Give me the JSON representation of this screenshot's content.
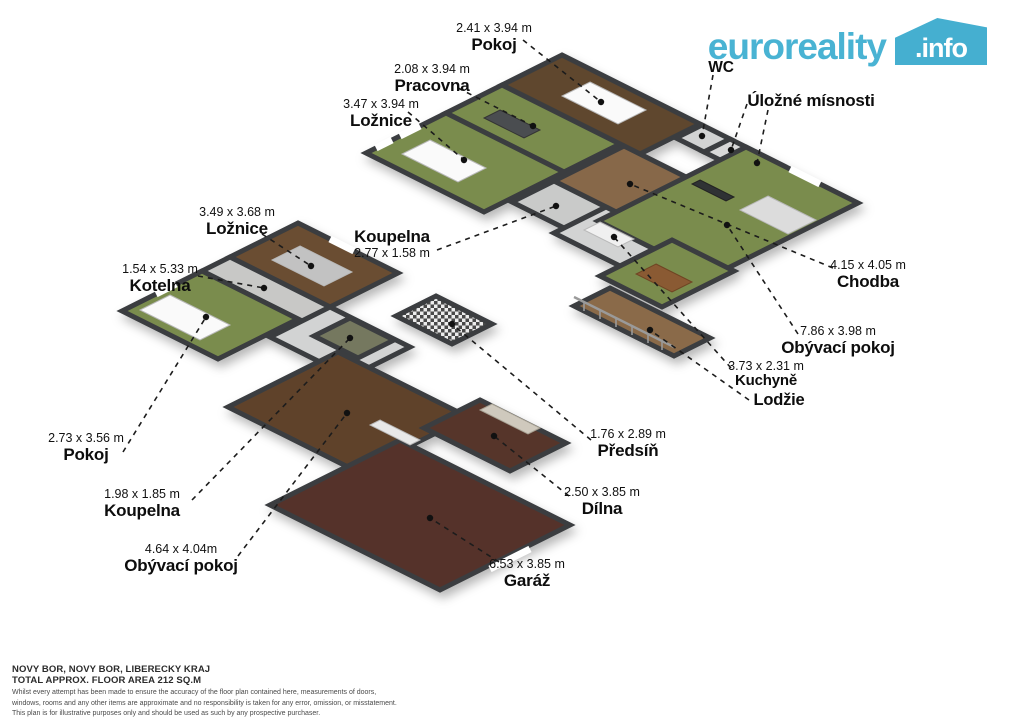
{
  "logo": {
    "brand": "euroreality",
    "tld": ".info",
    "accent_color": "#49b3d3"
  },
  "floors": {
    "upper": [
      "Pokoj",
      "Pracovna",
      "Ložnice",
      "WC",
      "Úložné mísnosti",
      "Koupelna",
      "Chodba",
      "Obývací pokoj",
      "Kuchyně",
      "Lodžie"
    ],
    "lower": [
      "Ložnice",
      "Kotelna",
      "Pokoj",
      "Koupelna",
      "Obývací pokoj",
      "Předsíň",
      "Dílna",
      "Garáž"
    ]
  },
  "labels": [
    {
      "id": "pokoj-upper",
      "name": "Pokoj",
      "dims": "2.41 x 3.94 m",
      "x": 494,
      "y": 21
    },
    {
      "id": "pracovna",
      "name": "Pracovna",
      "dims": "2.08 x 3.94 m",
      "x": 432,
      "y": 62
    },
    {
      "id": "loznice-upper",
      "name": "Ložnice",
      "dims": "3.47 x 3.94 m",
      "x": 381,
      "y": 97
    },
    {
      "id": "wc",
      "name": "WC",
      "dims": null,
      "x": 721,
      "y": 59,
      "size": 15.5
    },
    {
      "id": "ulozne-misnosti",
      "name": "Úložné mísnosti",
      "dims": null,
      "x": 811,
      "y": 91
    },
    {
      "id": "koupelna-upper",
      "name": "Koupelna",
      "dims": "2.77 x 1.58 m",
      "x": 392,
      "y": 227,
      "dims_below": true
    },
    {
      "id": "loznice-lower",
      "name": "Ložnice",
      "dims": "3.49 x 3.68 m",
      "x": 237,
      "y": 205
    },
    {
      "id": "kotelna",
      "name": "Kotelna",
      "dims": "1.54 x 5.33 m",
      "x": 160,
      "y": 262
    },
    {
      "id": "chodba",
      "name": "Chodba",
      "dims": "4.15 x 4.05 m",
      "x": 868,
      "y": 258
    },
    {
      "id": "obyvaci-pokoj-upper",
      "name": "Obývací pokoj",
      "dims": "7.86 x 3.98 m",
      "x": 838,
      "y": 324
    },
    {
      "id": "kuchyne",
      "name": "Kuchyně",
      "dims": "3.73 x 2.31 m",
      "x": 766,
      "y": 359,
      "size": 15
    },
    {
      "id": "lodzie",
      "name": "Lodžie",
      "dims": null,
      "x": 779,
      "y": 391,
      "size": 16.5
    },
    {
      "id": "pokoj-lower",
      "name": "Pokoj",
      "dims": "2.73 x 3.56 m",
      "x": 86,
      "y": 431
    },
    {
      "id": "koupelna-lower",
      "name": "Koupelna",
      "dims": "1.98 x 1.85 m",
      "x": 142,
      "y": 487
    },
    {
      "id": "obyvaci-pokoj-lower",
      "name": "Obývací pokoj",
      "dims": "4.64 x 4.04m",
      "x": 181,
      "y": 542
    },
    {
      "id": "predsin",
      "name": "Předsíň",
      "dims": "1.76 x 2.89 m",
      "x": 628,
      "y": 427
    },
    {
      "id": "dilna",
      "name": "Dílna",
      "dims": "2.50 x 3.85 m",
      "x": 602,
      "y": 485
    },
    {
      "id": "garaz",
      "name": "Garáž",
      "dims": "6.53 x 3.85 m",
      "x": 527,
      "y": 557
    }
  ],
  "footer": {
    "location": "NOVY BOR, NOVY BOR, LIBERECKY KRAJ",
    "area": "TOTAL APPROX. FLOOR AREA 212 SQ.M",
    "disclaimer_1": "Whilst every attempt has been made to ensure the accuracy of the floor plan contained here, measurements of doors,",
    "disclaimer_2": "windows, rooms and any other items are approximate and no responsibility is taken for any error, omission, or misstatement.",
    "disclaimer_3": "This plan is for illustrative purposes only and should be used as such by any prospective purchaser."
  },
  "colors": {
    "wall": "#3a3e41",
    "floor_green": "#7a8c4e",
    "floor_wood": "#6b4c30",
    "floor_hall": "#87674a",
    "floor_dark": "#57352b",
    "floor_tile": "#d2d3d3",
    "leader": "#1c1c1c",
    "logo_blue": "#49b3d3"
  }
}
